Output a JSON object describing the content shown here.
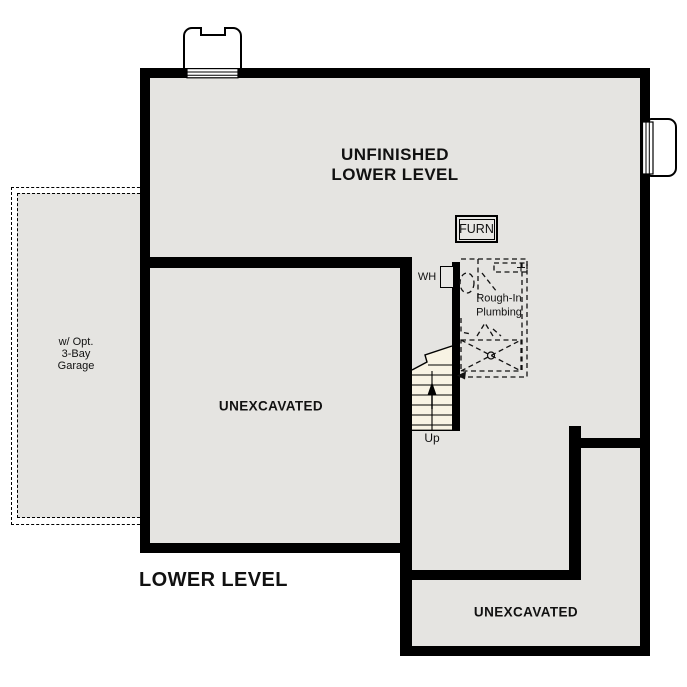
{
  "title": "LOWER LEVEL",
  "colors": {
    "floor_fill": "#e5e4e1",
    "wall": "#000000",
    "stairs_fill": "#f8f3e4",
    "background": "#ffffff"
  },
  "labels": {
    "main_area_line1": "UNFINISHED",
    "main_area_line2": "LOWER LEVEL",
    "furnace": "FURN",
    "water_heater": "WH",
    "plumbing_line1": "Rough-In",
    "plumbing_line2": "Plumbing",
    "unexcavated_left": "UNEXCAVATED",
    "unexcavated_bottom": "UNEXCAVATED",
    "garage_line1": "w/ Opt.",
    "garage_line2": "3-Bay",
    "garage_line3": "Garage",
    "stairs_direction": "Up"
  }
}
